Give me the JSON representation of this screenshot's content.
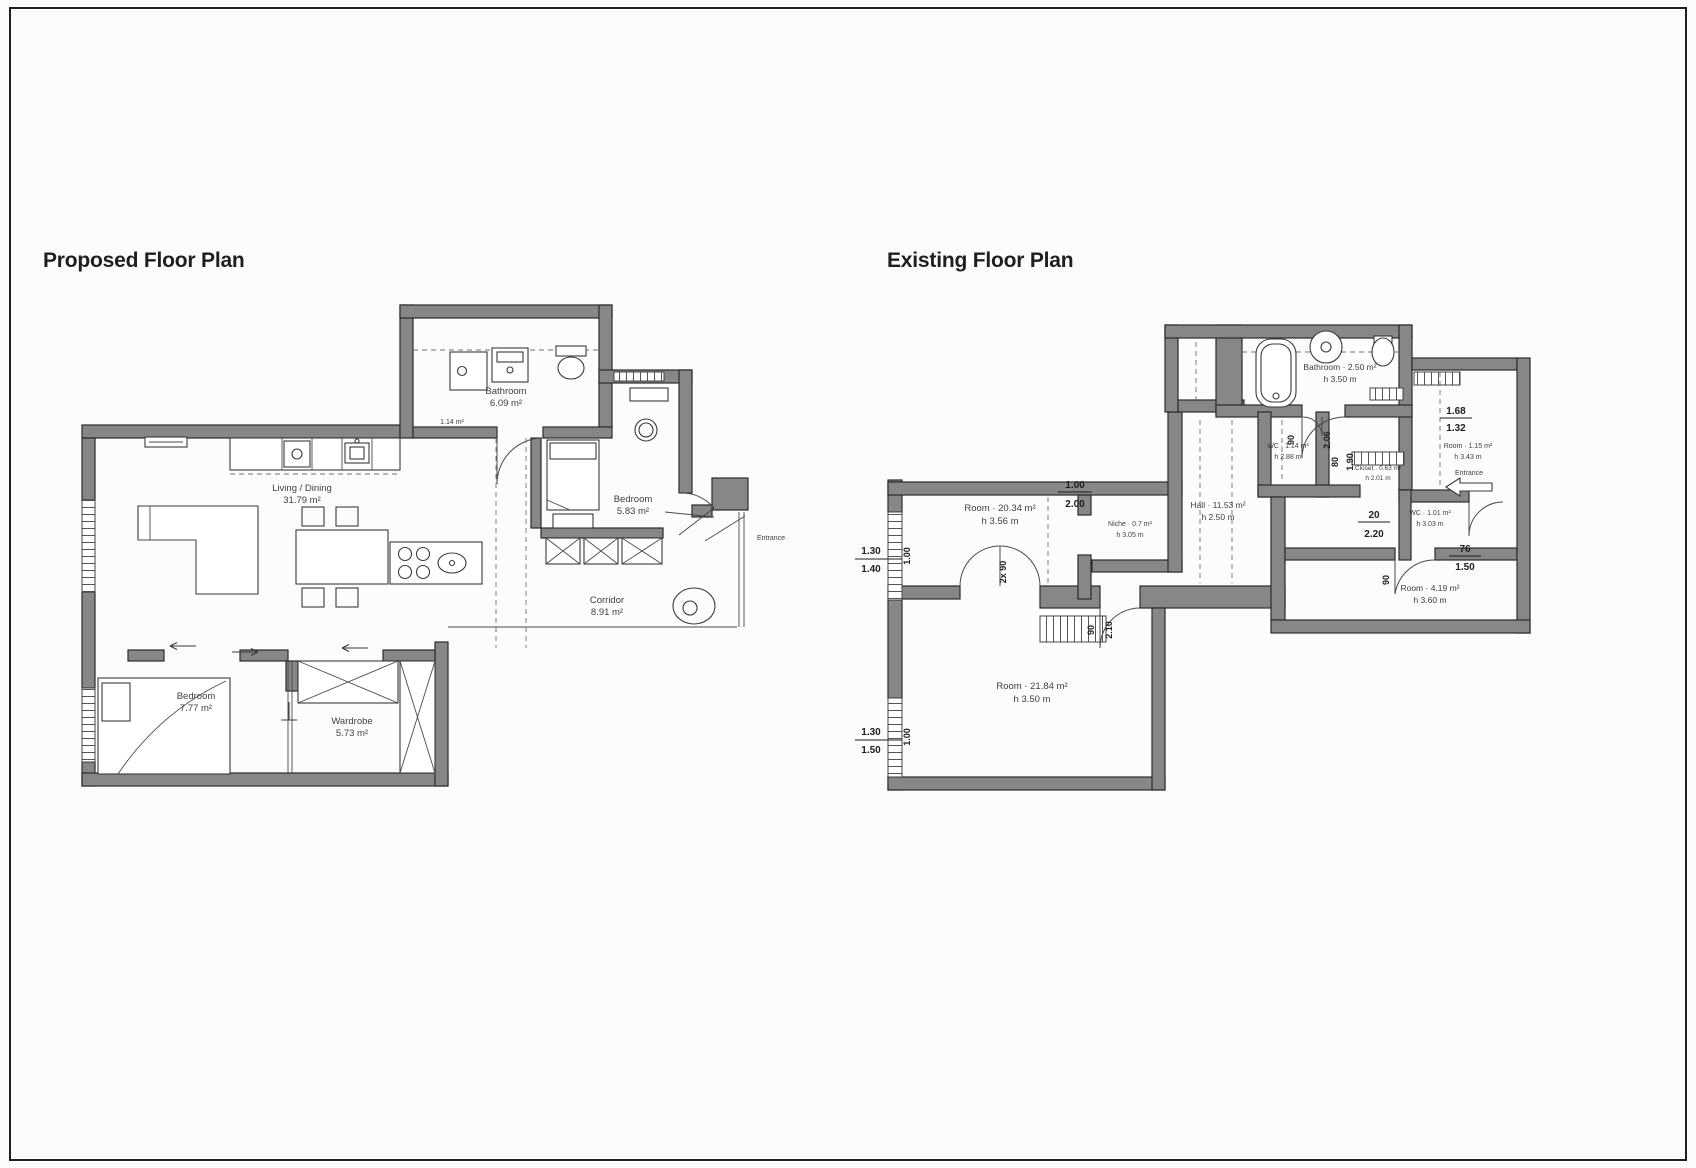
{
  "titles": {
    "proposed": "Proposed Floor Plan",
    "existing": "Existing Floor Plan"
  },
  "colors": {
    "wall": "#878787",
    "line": "#3a3a3a",
    "text": "#3f3f3f",
    "border": "#1e1e1e",
    "background": "#fcfcfc"
  },
  "proposed": {
    "living": {
      "name": "Living / Dining",
      "area": "31.79 m²"
    },
    "bathroom": {
      "name": "Bathroom",
      "area": "6.09 m²"
    },
    "shaft": {
      "area": "1.14 m²"
    },
    "bedroom": {
      "name": "Bedroom",
      "area": "5.83 m²"
    },
    "corridor": {
      "name": "Corridor",
      "area": "8.91 m²"
    },
    "bedroom2": {
      "name": "Bedroom",
      "area": "7.77 m²"
    },
    "wardrobe": {
      "name": "Wardrobe",
      "area": "5.73 m²"
    },
    "entry": {
      "name": "Entrance"
    }
  },
  "existing": {
    "bathroom": {
      "name": "Bathroom · 2.50 m²",
      "height": "h 3.50 m"
    },
    "wc": {
      "name": "WC · 1.14 m²",
      "height": "h 2.88 m"
    },
    "niche": {
      "name": "Niche · 0.7 m²",
      "height": "h 3.05 m"
    },
    "hall": {
      "name": "Hall · 11.53 m²",
      "height": "h 2.50 m"
    },
    "room_upper": {
      "name": "Room · 20.34 m²",
      "height": "h 3.56 m"
    },
    "room_lower": {
      "name": "Room · 21.84 m²",
      "height": "h 3.50 m"
    },
    "room_top_right": {
      "name": "Room · 1.15 m²",
      "height": "h 3.43 m"
    },
    "closet": {
      "name": "Closet · 0.63 m²",
      "height": "h 2.01 m"
    },
    "wc2": {
      "name": "WC · 1.01 m²",
      "height": "h 3.03 m"
    },
    "room_bottom_right": {
      "name": "Room · 4.19 m²",
      "height": "h 3.60 m"
    },
    "entrance": {
      "name": "Entrance"
    },
    "dims": {
      "win1_top": "1.30",
      "win1_bottom": "1.40",
      "win1_side": "1.00",
      "win2_top": "1.30",
      "win2_bottom": "1.50",
      "win2_side": "1.00",
      "opening_top": "1.00",
      "opening_bottom": "2.00",
      "corridor_top": "20",
      "corridor_bottom": "2.20",
      "door_hall_w": "90",
      "door_hall_l": "2.10",
      "door_wc_w": "80",
      "door_wc_l": "1.90",
      "door_bath_w": "90",
      "door_bath_l": "2.06",
      "right_top": "1.68",
      "right_bottom": "1.32",
      "entry_top": "76",
      "entry_bottom": "1.50",
      "double_door": "2x 90",
      "door_br": "90"
    }
  }
}
